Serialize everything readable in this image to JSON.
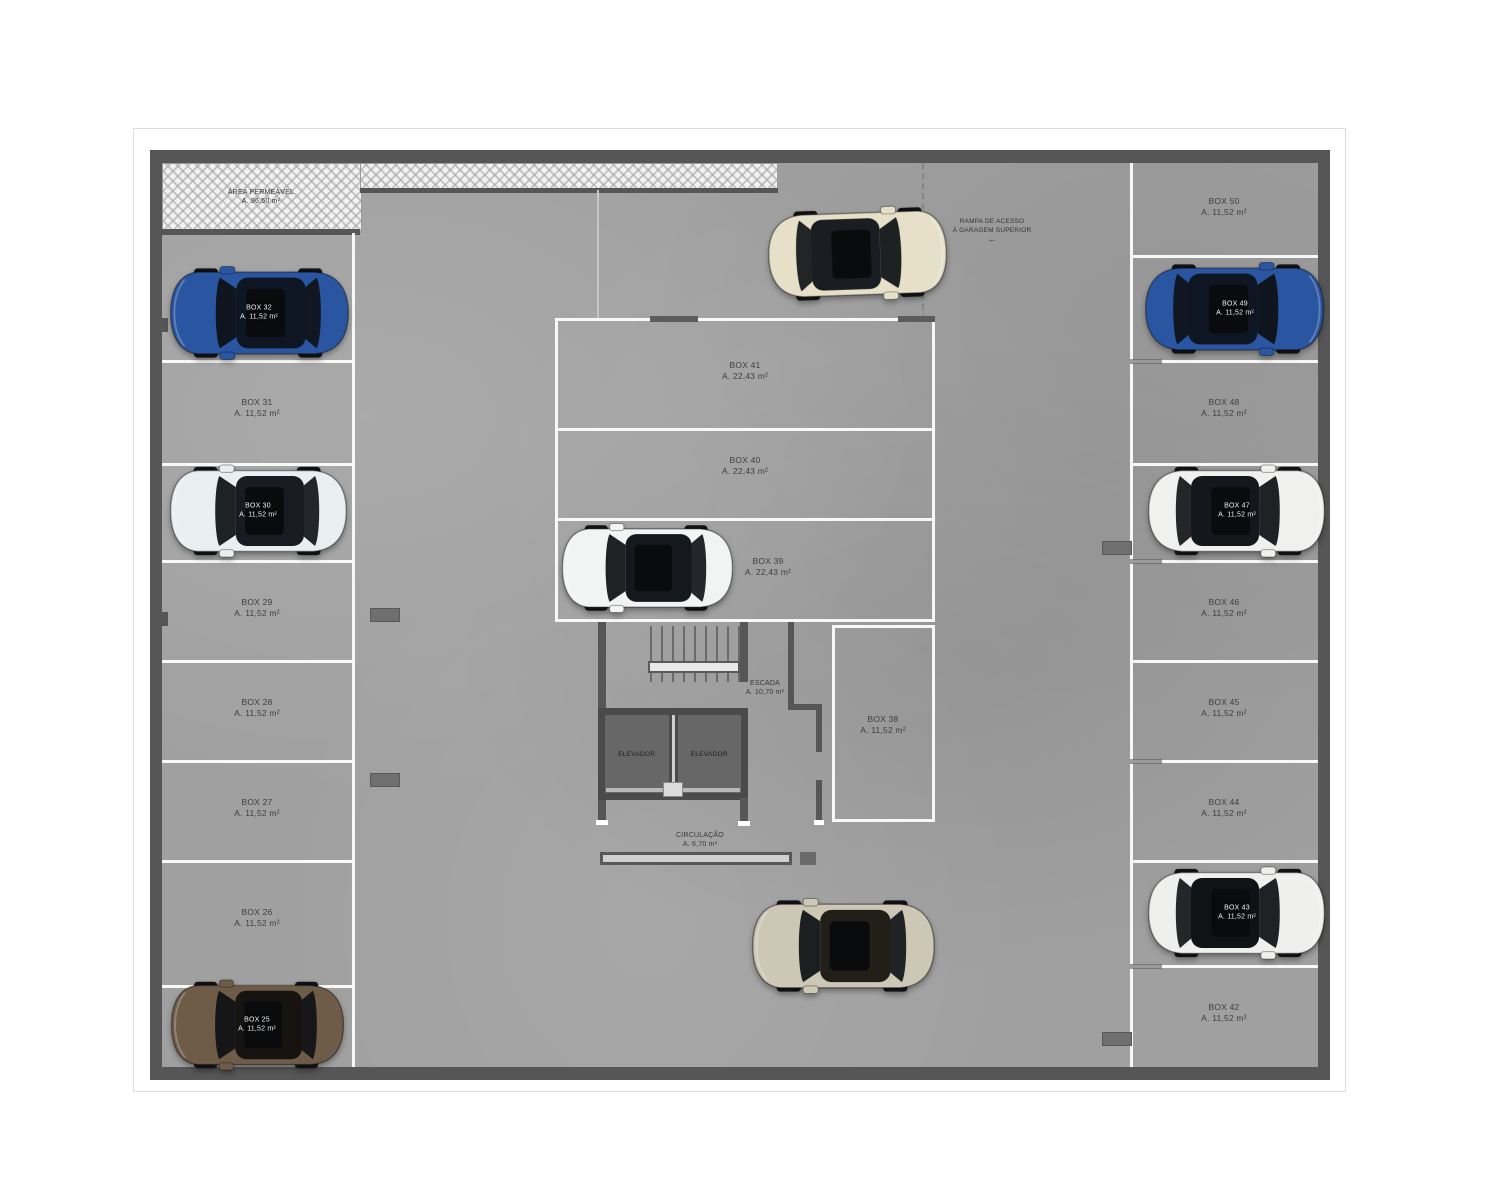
{
  "areas": {
    "permeable": {
      "name": "ÁREA PERMEÁVEL",
      "area": "A. 96,50 m²"
    },
    "ramp": {
      "line1": "RAMPA DE ACESSO",
      "line2": "À GARAGEM SUPERIOR",
      "arrow": "←"
    },
    "stairs": {
      "name": "ESCADA",
      "area": "A. 10,70 m²"
    },
    "circulation": {
      "name": "CIRCULAÇÃO",
      "area": "A. 6,70 m²"
    },
    "elevators": [
      {
        "label": "ELEVADOR"
      },
      {
        "label": "ELEVADOR"
      }
    ]
  },
  "center_boxes": [
    {
      "box": "BOX 41",
      "area": "A. 22,43 m²"
    },
    {
      "box": "BOX 40",
      "area": "A. 22,43 m²"
    },
    {
      "box": "BOX 39",
      "area": "A. 22,43 m²",
      "car_color": "#f2f3f3",
      "car_roof": "#15181c"
    },
    {
      "box": "BOX 38",
      "area": "A. 11,52 m²"
    }
  ],
  "stalls": {
    "left": [
      {
        "box": "BOX 32",
        "area": "A. 11,52 m²",
        "occupied": true,
        "car_color": "#2a55a0",
        "car_roof": "#0e1624"
      },
      {
        "box": "BOX 31",
        "area": "A. 11,52 m²"
      },
      {
        "box": "BOX 30",
        "area": "A. 11,52 m²",
        "occupied": true,
        "car_color": "#e9eef0",
        "car_roof": "#181c22"
      },
      {
        "box": "BOX 29",
        "area": "A. 11,52 m²"
      },
      {
        "box": "BOX 28",
        "area": "A. 11,52 m²"
      },
      {
        "box": "BOX 27",
        "area": "A. 11,52 m²"
      },
      {
        "box": "BOX 26",
        "area": "A. 11,52 m²"
      },
      {
        "box": "BOX 25",
        "area": "A. 11,52 m²",
        "occupied": true,
        "car_color": "#6e5c49",
        "car_roof": "#161310"
      }
    ],
    "right": [
      {
        "box": "BOX 50",
        "area": "A. 11,52 m²"
      },
      {
        "box": "BOX 49",
        "area": "A. 11,52 m²",
        "occupied": true,
        "car_color": "#2a55a0",
        "car_roof": "#0e1624"
      },
      {
        "box": "BOX 48",
        "area": "A. 11,52 m²"
      },
      {
        "box": "BOX 47",
        "area": "A. 11,52 m²",
        "occupied": true,
        "car_color": "#f0f1ef",
        "car_roof": "#14171c"
      },
      {
        "box": "BOX 46",
        "area": "A. 11,52 m²"
      },
      {
        "box": "BOX 45",
        "area": "A. 11,52 m²"
      },
      {
        "box": "BOX 44",
        "area": "A. 11,52 m²"
      },
      {
        "box": "BOX 43",
        "area": "A. 11,52 m²",
        "occupied": true,
        "car_color": "#eff0ee",
        "car_roof": "#101316"
      },
      {
        "box": "BOX 42",
        "area": "A. 11,52 m²"
      }
    ]
  },
  "lane_cars": [
    {
      "name": "top-lane-car",
      "car_color": "#e6e0c8",
      "car_roof": "#1a1d22"
    },
    {
      "name": "bottom-lane-car",
      "car_color": "#cdc7b5",
      "car_roof": "#221f19"
    }
  ],
  "palette": {
    "floor": "#a0a0a0",
    "wall": "#565656",
    "stall_line": "#ffffff"
  }
}
